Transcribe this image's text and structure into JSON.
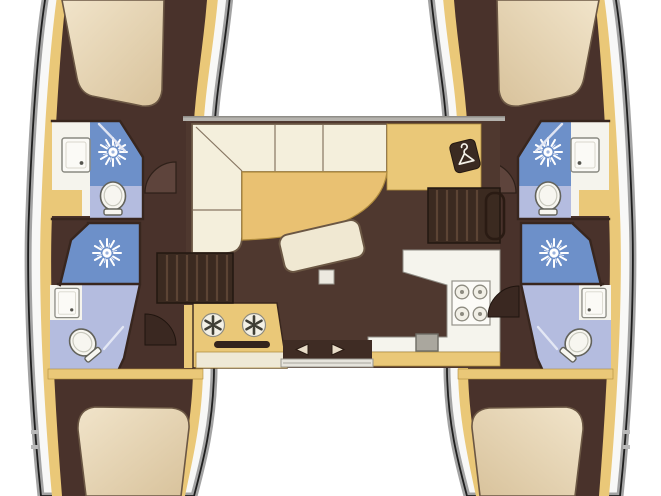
{
  "title": "Catamaran interior layout floor plan (4 cabins / 4 heads)",
  "type": "floor-plan",
  "orientation": {
    "top": "bow",
    "bottom": "stern",
    "left": "port hull",
    "right": "starboard hull"
  },
  "colors": {
    "bg": "#ffffff",
    "shell": "#a3a3a3",
    "hullline": "#1f1f1f",
    "deck": "#f8f8f7",
    "trim": "#eac878",
    "trimdark": "#b08c3e",
    "interior": "#49322b",
    "floor": "#4f382f",
    "sofa": "#f4efdc",
    "outline": "#6b5744",
    "table": "#e9c172",
    "shower": "#6d90c9",
    "bath": "#b4bcdf",
    "white": "#f5f4ed",
    "wall": "#38261e",
    "steps": "#3b2a20",
    "tread": "#5c4434",
    "bedlight": "#f1e4ca",
    "beddark": "#d8c29b",
    "track": "#e6e4dc",
    "slot": "#33231c",
    "sink": "#aaa79e"
  },
  "rooms": {
    "saloon": {
      "label": "Saloon & galley",
      "fixtures": [
        "L-shaped sofa",
        "curved cocktail table",
        "nav / chart area",
        "hanging wardrobe locker",
        "freestanding bench seat",
        "table pedestal",
        "galley unit with two round burners",
        "oven",
        "four-burner stove",
        "counter sink",
        "sliding aft door",
        "port companionway steps",
        "starboard companionway steps with handrail"
      ]
    },
    "port_hull": {
      "label": "Port hull",
      "fixtures": [
        "forward cabin double berth",
        "forward head: washbasin, shower, toilet",
        "aft head: shower, washbasin, toilet",
        "aft cabin double berth",
        "cabin doors"
      ]
    },
    "starboard_hull": {
      "label": "Starboard hull",
      "fixtures": [
        "forward cabin double berth",
        "forward head: washbasin, shower, toilet",
        "aft head: shower, washbasin, toilet",
        "aft cabin double berth",
        "cabin doors"
      ]
    }
  },
  "icons": [
    "shower-rose-icon",
    "clothes-hanger-icon",
    "burner-icon",
    "stove-burner-icon",
    "toilet-icon",
    "washbasin-icon",
    "sliding-door-arrows-icon"
  ]
}
